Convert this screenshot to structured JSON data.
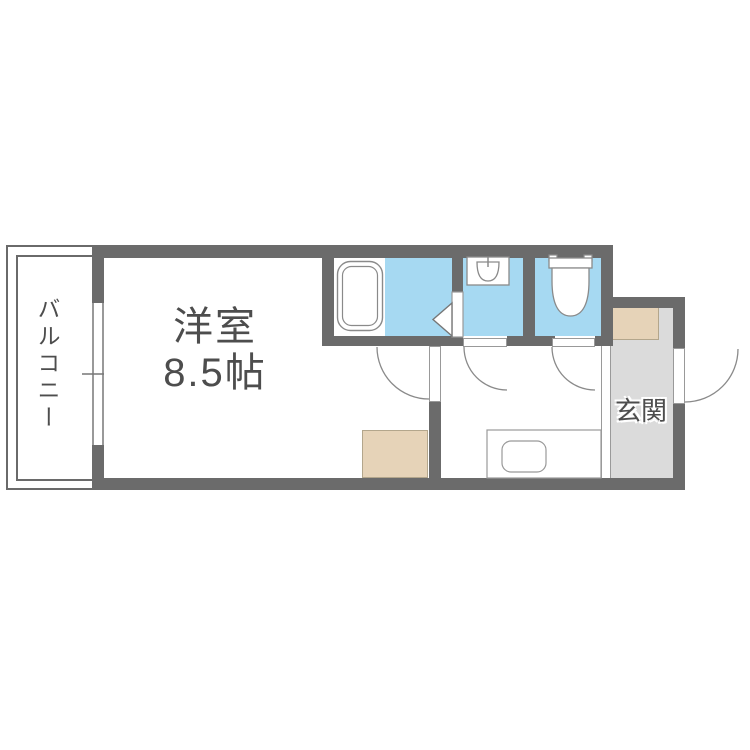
{
  "plan": {
    "type": "apartment-floor-plan",
    "rooms": {
      "western_room": {
        "label": "洋室",
        "size": "8.5帖"
      },
      "balcony": {
        "label": "バルコニー"
      },
      "entrance": {
        "label": "玄関"
      },
      "bathroom": {
        "label": ""
      },
      "washroom": {
        "label": ""
      },
      "toilet_room": {
        "label": ""
      }
    },
    "fixtures": {
      "bathtub": "bathtub-icon",
      "washbasin": "washbasin-icon",
      "toilet": "toilet-icon",
      "kitchen_sink": "kitchen-sink-icon",
      "folding_door": "folding-door-icon",
      "shoe_cabinet": "shoe-cabinet",
      "storage": "storage-box"
    },
    "colors": {
      "wall": "#6b6b6b",
      "wet_area_floor": "#a6d9f2",
      "entrance_floor": "#dbdbdb",
      "cabinet_tan": "#e6d3b8",
      "label_text": "#4d4d4d"
    }
  }
}
